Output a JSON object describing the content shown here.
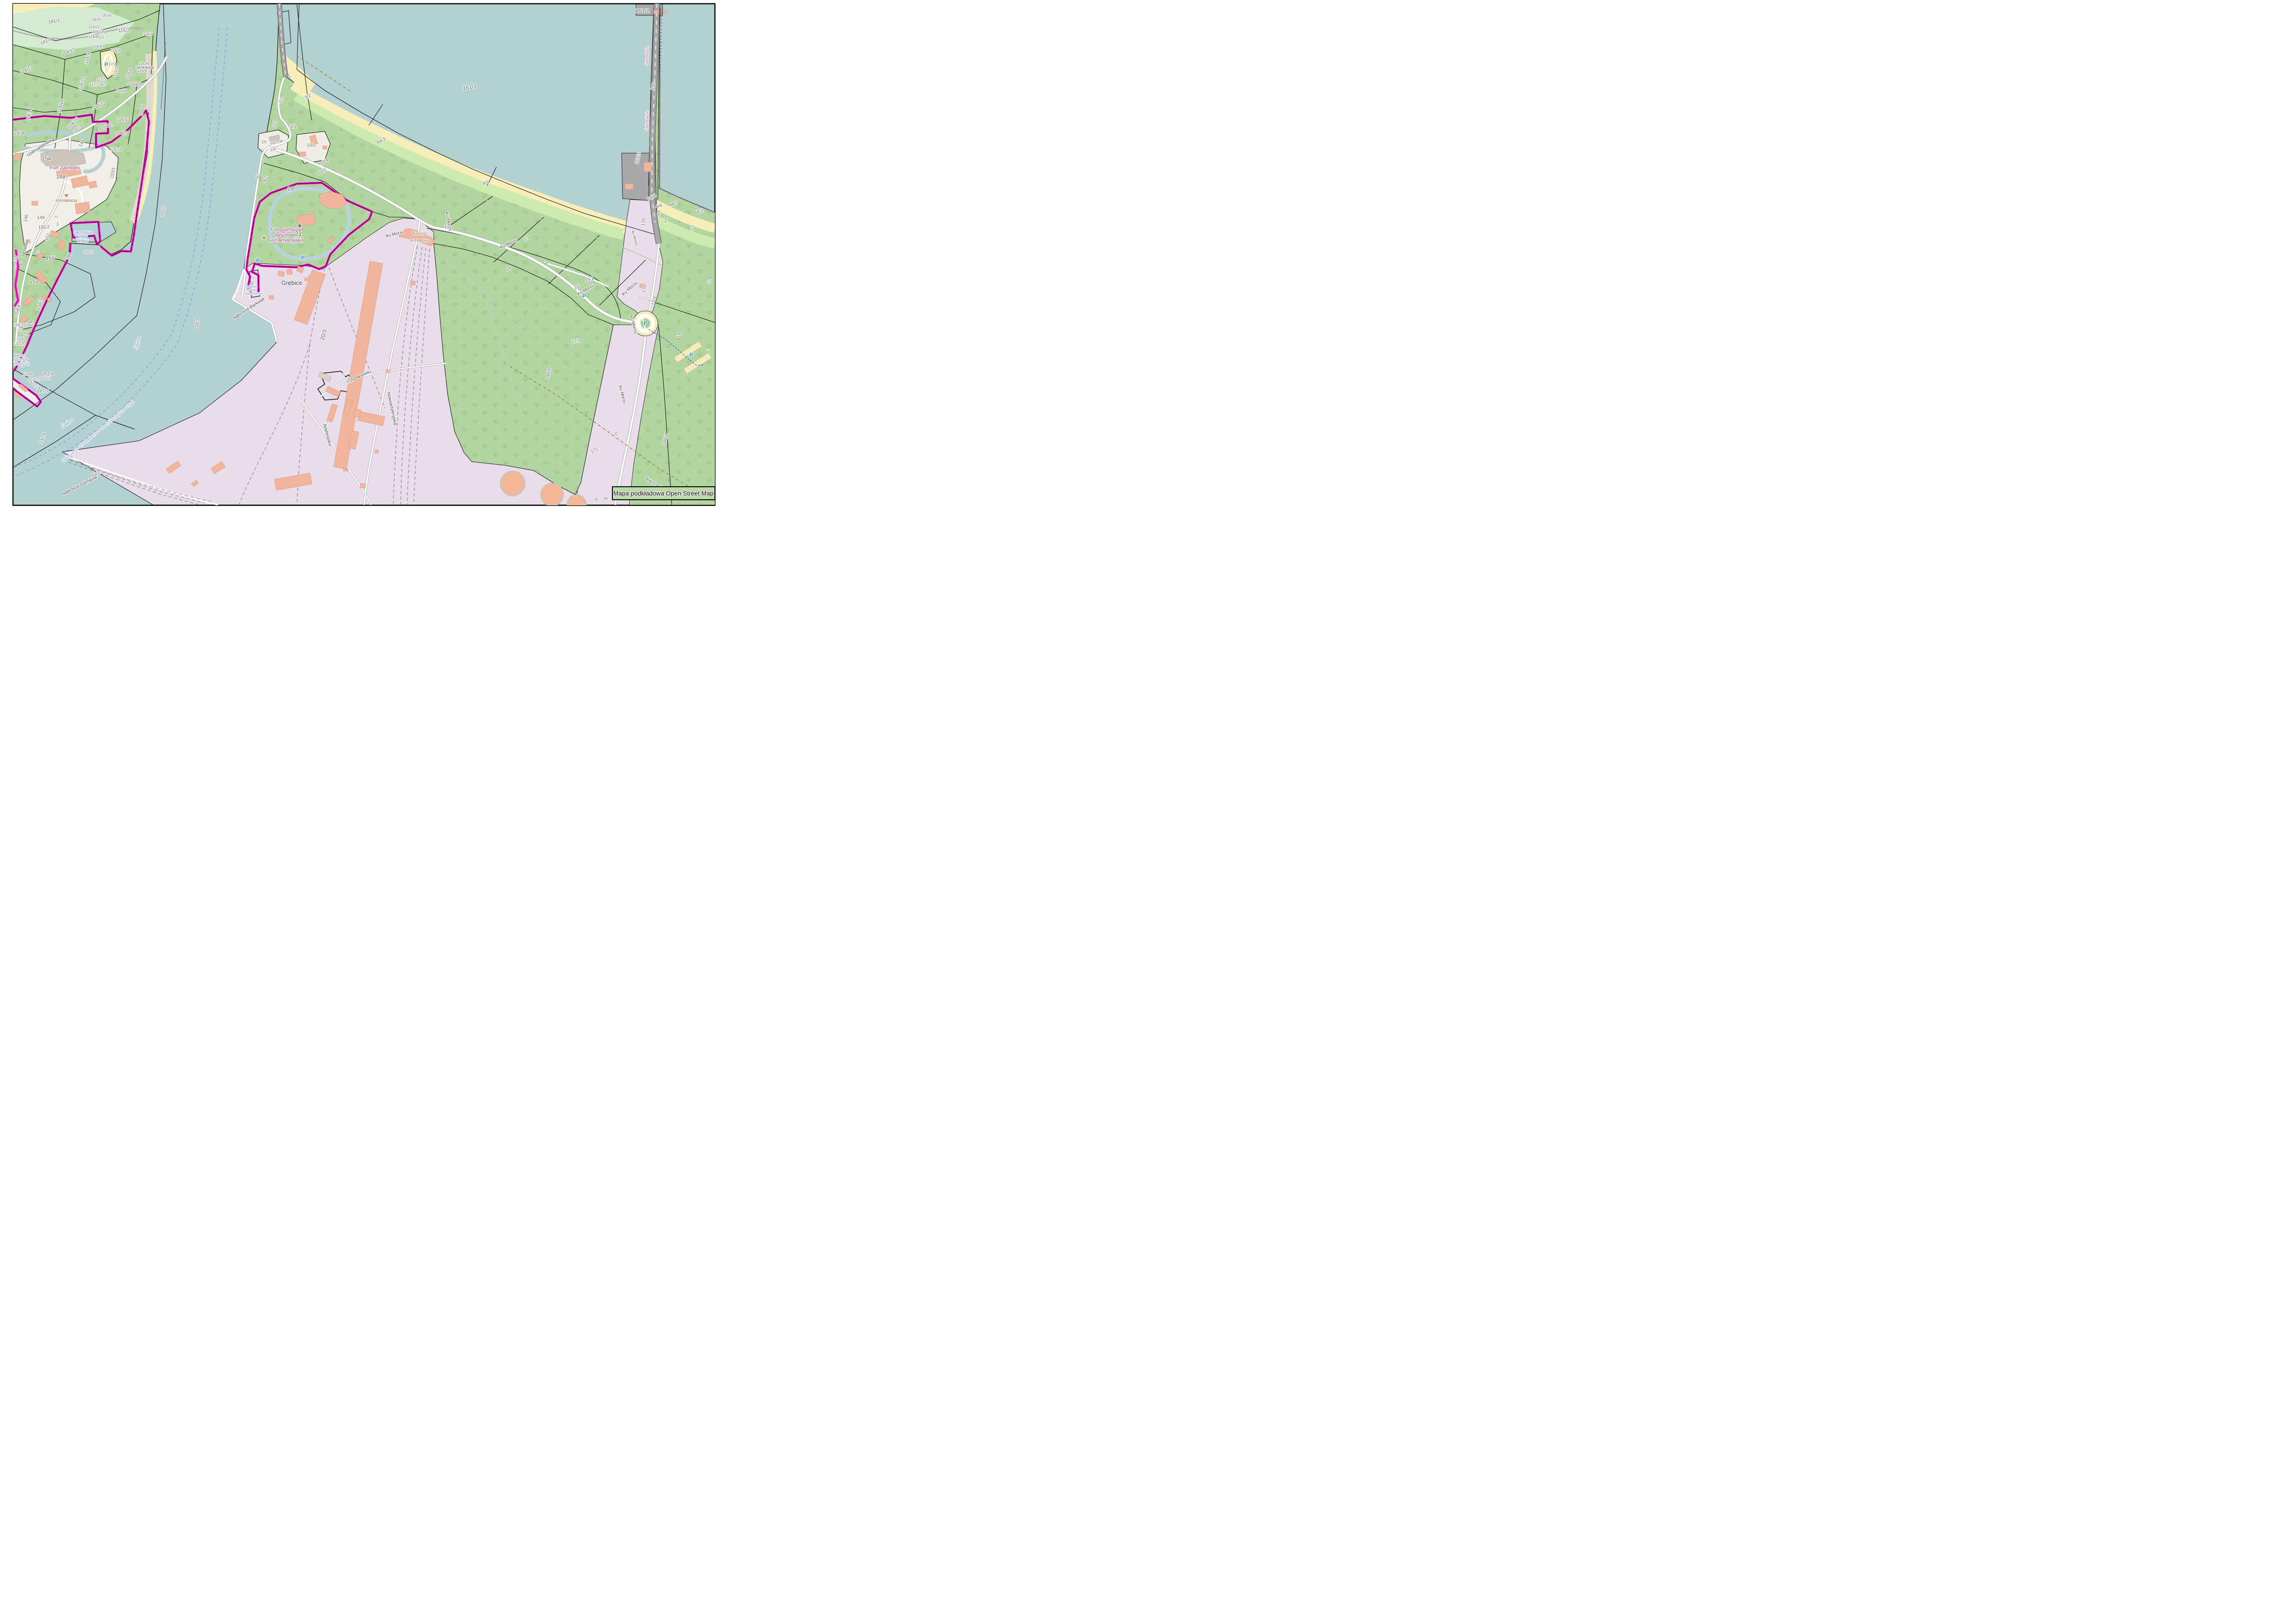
{
  "map": {
    "attribution": "Mapa podkładowa Open Street Map",
    "colors": {
      "water": "#b3d1d0",
      "forest": "#b2d6a0",
      "grass": "#cdebb0",
      "sand": "#f7eeb9",
      "industrial": "#eaddea",
      "building": "#f1b49c",
      "building_gray": "#cdc5bb",
      "boundary_magenta": "#ff00cc",
      "admin_purple": "#b06fc0",
      "road": "#ffffff",
      "pier_gray": "#a8a8a8",
      "moat": "#b9d3de",
      "frame": "#000000"
    },
    "legend": "labels entries = [text, x, y, rotation, class]; classes: p/p9/p12/p13 parcel numbers, st street names, w water names, wi water italic, fr ferry route, pl place name, f fort name, poi points of interest, b admin boundary, hn house number, ic* icons",
    "labels": [
      [
        "181/1",
        117,
        49,
        -10,
        "p"
      ],
      [
        "181/6",
        230,
        36,
        0,
        "p9"
      ],
      [
        "181/5",
        208,
        45,
        0,
        "p9"
      ],
      [
        "114/22",
        203,
        61,
        0,
        "p9"
      ],
      [
        "114/18",
        211,
        71,
        0,
        "p9"
      ],
      [
        "114/8",
        201,
        82,
        0,
        "p9"
      ],
      [
        "115",
        218,
        83,
        0,
        "p9"
      ],
      [
        "116/2",
        267,
        69,
        0,
        "p"
      ],
      [
        "116/4",
        319,
        76,
        0,
        "p9"
      ],
      [
        "181/4",
        100,
        92,
        -22,
        "p"
      ],
      [
        "114/17",
        149,
        115,
        -22,
        "p"
      ],
      [
        "114/19",
        192,
        124,
        -75,
        "p"
      ],
      [
        "114/20",
        211,
        103,
        0,
        "p9"
      ],
      [
        "116/3",
        249,
        112,
        0,
        "p9"
      ],
      [
        "117/2",
        240,
        141,
        0,
        "p9"
      ],
      [
        "116/5",
        252,
        156,
        -72,
        "p9"
      ],
      [
        "116/6",
        281,
        160,
        -68,
        "p"
      ],
      [
        "200/8",
        310,
        140,
        0,
        "p9"
      ],
      [
        "Gerardowa",
        312,
        148,
        0,
        "st8"
      ],
      [
        "116/9",
        306,
        155,
        0,
        "p9"
      ],
      [
        "117/3",
        218,
        174,
        0,
        "p9"
      ],
      [
        "117/4",
        203,
        185,
        0,
        "p9"
      ],
      [
        "116/7",
        219,
        185,
        0,
        "p9"
      ],
      [
        "116/10",
        290,
        185,
        0,
        "p"
      ],
      [
        "116/8",
        261,
        199,
        0,
        "p9"
      ],
      [
        "114/21",
        180,
        181,
        -75,
        "p"
      ],
      [
        "114/16",
        134,
        229,
        -75,
        "p"
      ],
      [
        "114/13",
        58,
        154,
        -22,
        "p"
      ],
      [
        "114/14",
        66,
        248,
        -75,
        "p"
      ],
      [
        "116/11",
        215,
        230,
        -22,
        "p"
      ],
      [
        "116/12",
        228,
        276,
        -22,
        "p"
      ],
      [
        "116/13",
        266,
        261,
        0,
        "p"
      ],
      [
        "200/5",
        261,
        290,
        0,
        "p"
      ],
      [
        "200/6",
        310,
        238,
        -75,
        "p"
      ],
      [
        "114/10",
        160,
        267,
        -48,
        "p"
      ],
      [
        "117/1",
        169,
        278,
        -52,
        "p"
      ],
      [
        "114/38",
        40,
        290,
        0,
        "p"
      ],
      [
        "116/14",
        250,
        325,
        0,
        "p9"
      ],
      [
        "Uzdrowiskowa",
        86,
        321,
        -33,
        "st"
      ],
      [
        "146",
        179,
        310,
        -62,
        "p"
      ],
      [
        "154",
        100,
        346,
        0,
        "p12"
      ],
      [
        "Fort Zachodni",
        140,
        365,
        0,
        "f"
      ],
      [
        "148",
        131,
        385,
        0,
        "p12"
      ],
      [
        "Konstelacja",
        143,
        435,
        0,
        "poi"
      ],
      [
        "153/1",
        246,
        373,
        -80,
        "p"
      ],
      [
        "146",
        59,
        471,
        -75,
        "p"
      ],
      [
        "149",
        88,
        472,
        0,
        "p"
      ],
      [
        "150",
        91,
        493,
        0,
        "p"
      ],
      [
        "2",
        104,
        492,
        0,
        "p"
      ],
      [
        "1",
        124,
        486,
        0,
        "p"
      ],
      [
        "4a",
        121,
        469,
        0,
        "hn"
      ],
      [
        "152",
        106,
        512,
        -70,
        "p"
      ],
      [
        "155",
        108,
        560,
        0,
        "p12"
      ],
      [
        "4",
        82,
        545,
        0,
        "hn"
      ],
      [
        "Jachtowa",
        57,
        536,
        -75,
        "st"
      ],
      [
        "Jacht Klub",
        179,
        504,
        0,
        "w"
      ],
      [
        "Cztery",
        176,
        513,
        0,
        "w"
      ],
      [
        "Wiatry",
        178,
        522,
        0,
        "w"
      ],
      [
        "202/2",
        191,
        546,
        0,
        "p9"
      ],
      [
        "145/31",
        35,
        566,
        -75,
        "p"
      ],
      [
        "151",
        73,
        610,
        0,
        "p12"
      ],
      [
        "201",
        151,
        553,
        -60,
        "p"
      ],
      [
        "156/1",
        89,
        656,
        -75,
        "p"
      ],
      [
        "158/4",
        41,
        670,
        -75,
        "p"
      ],
      [
        "158/3",
        39,
        703,
        0,
        "p9"
      ],
      [
        "Jachtowa",
        56,
        702,
        -30,
        "st8"
      ],
      [
        "159/5",
        62,
        704,
        0,
        "p9"
      ],
      [
        "159/6",
        49,
        718,
        30,
        "p9"
      ],
      [
        "159/4",
        46,
        733,
        0,
        "p9"
      ],
      [
        "122/25",
        41,
        744,
        0,
        "p9"
      ],
      [
        "Basen",
        42,
        769,
        0,
        "w"
      ],
      [
        "Północny w",
        38,
        778,
        0,
        "w"
      ],
      [
        "Świnoujściu",
        40,
        787,
        0,
        "w"
      ],
      [
        "123/5",
        53,
        782,
        -75,
        "p9"
      ],
      [
        "123/6",
        60,
        809,
        0,
        "p9"
      ],
      [
        "202/4",
        103,
        809,
        0,
        "p"
      ],
      [
        "122/21",
        73,
        820,
        0,
        "p9"
      ],
      [
        "122/17",
        97,
        818,
        0,
        "p9"
      ],
      [
        "122/19",
        74,
        832,
        35,
        "p9"
      ],
      [
        "147/7",
        92,
        846,
        0,
        "p"
      ],
      [
        "147/6",
        95,
        945,
        -70,
        "p"
      ],
      [
        "59/23",
        24,
        757,
        -75,
        "p9"
      ],
      [
        "Świna",
        300,
        740,
        -75,
        "wi"
      ],
      [
        "Świna",
        147,
        915,
        -38,
        "wi"
      ],
      [
        "Świnoujście - Ystad, Rønne - Ystad; Świnoujście - Ystad",
        213,
        932,
        -40,
        "fr"
      ],
      [
        "Nabrzeże Górników",
        173,
        1049,
        -27,
        "st"
      ],
      [
        "59/2",
        208,
        1025,
        -27,
        "p"
      ],
      [
        "202/3",
        355,
        455,
        -80,
        "p"
      ],
      [
        "59/3",
        428,
        697,
        -80,
        "p"
      ],
      [
        "2/1",
        609,
        216,
        -75,
        "p"
      ],
      [
        "3/2",
        665,
        211,
        -28,
        "p"
      ],
      [
        "2/7",
        595,
        267,
        -75,
        "p"
      ],
      [
        "3/1",
        632,
        276,
        0,
        "p"
      ],
      [
        "6",
        609,
        306,
        -60,
        "p"
      ],
      [
        "2/5",
        569,
        309,
        0,
        "p9"
      ],
      [
        "2/6",
        588,
        311,
        0,
        "p9"
      ],
      [
        "2/4",
        589,
        325,
        -15,
        "p9"
      ],
      [
        "7",
        567,
        329,
        0,
        "p9"
      ],
      [
        "8",
        566,
        351,
        0,
        "p9"
      ],
      [
        "9/2",
        574,
        387,
        -75,
        "p"
      ],
      [
        "9/1",
        558,
        380,
        -75,
        "p9"
      ],
      [
        "10/2",
        671,
        316,
        0,
        "p"
      ],
      [
        "10/1",
        696,
        372,
        -25,
        "p"
      ],
      [
        "19",
        626,
        411,
        0,
        "p12"
      ],
      [
        "10/4",
        700,
        351,
        -30,
        "p"
      ],
      [
        "64/3",
        823,
        306,
        -27,
        "p"
      ],
      [
        "4/1",
        1048,
        397,
        -20,
        "p"
      ],
      [
        "161/1",
        1013,
        192,
        -8,
        "p12"
      ],
      [
        "Fort Gerharda",
        617,
        498,
        0,
        "f"
      ],
      [
        "(Wschodni",
        616,
        510,
        0,
        "f"
      ],
      [
        "Fort Artyleryjski)",
        616,
        521,
        0,
        "f"
      ],
      [
        "21",
        643,
        508,
        0,
        "p13"
      ],
      [
        "Grębice",
        629,
        614,
        0,
        "pl"
      ],
      [
        "Nabrzeże Barkowe",
        538,
        667,
        -33,
        "st"
      ],
      [
        "20/3",
        701,
        723,
        -75,
        "p12"
      ],
      [
        "56",
        546,
        612,
        -80,
        "p9"
      ],
      [
        "Latarnia",
        542,
        620,
        0,
        "w7"
      ],
      [
        "morska",
        542,
        627,
        0,
        "w7"
      ],
      [
        "Świnoujście",
        546,
        635,
        0,
        "w7"
      ],
      [
        "Kasztanowa",
        773,
        815,
        -25,
        "st"
      ],
      [
        "27",
        754,
        824,
        0,
        "p12"
      ],
      [
        "16",
        739,
        810,
        0,
        "hn"
      ],
      [
        "Artyleryjska",
        703,
        938,
        75,
        "st"
      ],
      [
        "Nowoartyleryjska",
        842,
        881,
        78,
        "st"
      ],
      [
        "Bateria",
        904,
        506,
        0,
        "poi2"
      ],
      [
        "Brzegowa",
        905,
        521,
        0,
        "poi2"
      ],
      [
        "12",
        963,
        491,
        0,
        "p"
      ],
      [
        "ku Morzu",
        852,
        507,
        -12,
        "st"
      ],
      [
        "Ku Morzu",
        964,
        478,
        78,
        "st"
      ],
      [
        "Ku Morzu",
        1098,
        528,
        -25,
        "st"
      ],
      [
        "Ku Morzu",
        1264,
        627,
        -30,
        "st"
      ],
      [
        "Ku Morzu",
        1359,
        624,
        -42,
        "st"
      ],
      [
        "Ku Morzu",
        1363,
        700,
        75,
        "st"
      ],
      [
        "Ku Morzu",
        1339,
        851,
        75,
        "st"
      ],
      [
        "ku Morzu",
        1366,
        514,
        75,
        "st8"
      ],
      [
        "13",
        1136,
        517,
        -20,
        "p"
      ],
      [
        "14",
        1098,
        582,
        -20,
        "p"
      ],
      [
        "15/1",
        1271,
        605,
        -15,
        "p"
      ],
      [
        "16",
        1244,
        622,
        -15,
        "p"
      ],
      [
        "17/1",
        1242,
        738,
        -8,
        "p"
      ],
      [
        "170",
        1390,
        479,
        -80,
        "p"
      ],
      [
        "170",
        1392,
        623,
        -80,
        "p"
      ],
      [
        "15/3",
        1412,
        649,
        -75,
        "p"
      ],
      [
        "18",
        1467,
        723,
        -75,
        "p"
      ],
      [
        "161/2",
        1385,
        27,
        0,
        "p12"
      ],
      [
        "160",
        1411,
        186,
        -80,
        "p"
      ],
      [
        "161/3",
        1378,
        342,
        -75,
        "p"
      ],
      [
        "64/6",
        1406,
        428,
        -25,
        "p"
      ],
      [
        "4/4",
        1421,
        447,
        -15,
        "p"
      ],
      [
        "64/7",
        1453,
        442,
        -15,
        "p"
      ],
      [
        "64/2",
        1507,
        459,
        -15,
        "p"
      ],
      [
        "4/5",
        1423,
        460,
        -75,
        "p9"
      ],
      [
        "5/4",
        1437,
        476,
        -75,
        "p9"
      ],
      [
        "5/2",
        1495,
        491,
        -75,
        "p9"
      ],
      [
        "52",
        1532,
        607,
        -75,
        "p9"
      ],
      [
        "146/8",
        1185,
        807,
        -75,
        "p"
      ],
      [
        "148/4",
        1437,
        948,
        -75,
        "p"
      ],
      [
        "171",
        1283,
        973,
        -32,
        "p"
      ],
      [
        "25",
        1331,
        935,
        -80,
        "p9"
      ],
      [
        "dojazd pożarowy 26",
        1421,
        1051,
        32,
        "st8"
      ],
      [
        "26",
        1288,
        1078,
        -80,
        "p9"
      ],
      [
        "60",
        1306,
        1077,
        0,
        "p9"
      ],
      [
        "Świnoujście",
        1397,
        120,
        -88,
        "b"
      ],
      [
        "Świnoujście",
        1397,
        260,
        -88,
        "b"
      ],
      [
        "P",
        229,
        143,
        0,
        "icp"
      ],
      [
        "P",
        556,
        566,
        0,
        "icp"
      ],
      [
        "P",
        653,
        560,
        0,
        "icp"
      ],
      [
        "P",
        1259,
        642,
        0,
        "icp"
      ],
      [
        "P",
        1391,
        701,
        0,
        "icp"
      ],
      [
        "P",
        1490,
        769,
        0,
        "icp"
      ],
      [
        "Ⅲ",
        646,
        490,
        0,
        "icmus"
      ],
      [
        "∗",
        569,
        517,
        0,
        "icfl"
      ],
      [
        "Ψ",
        143,
        425,
        0,
        "icrest"
      ],
      [
        "i",
        45,
        573,
        0,
        "icinfo"
      ],
      [
        "▪",
        546,
        602,
        0,
        "iclh"
      ],
      [
        "←",
        1526,
        756,
        0,
        "icar"
      ],
      [
        "→",
        1176,
        566,
        -25,
        "icar"
      ]
    ]
  }
}
